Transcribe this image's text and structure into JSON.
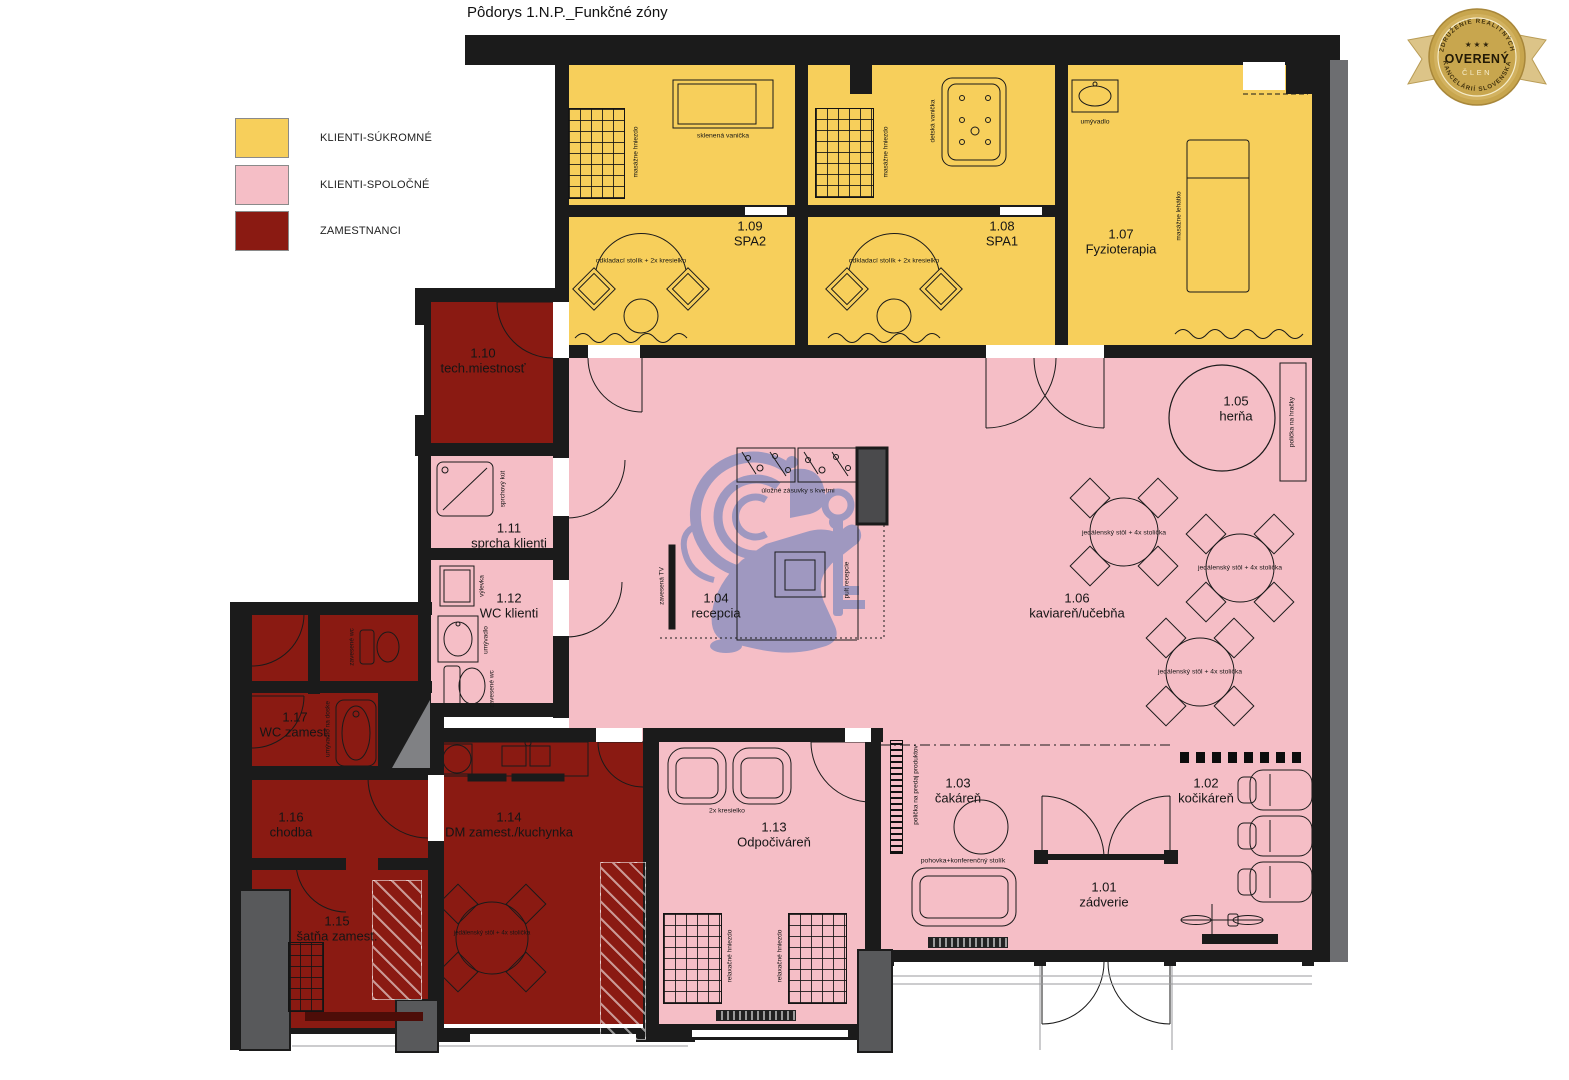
{
  "title": "Pôdorys 1.N.P._Funkčné zóny",
  "legend": {
    "private": {
      "label": "KLIENTI-SÚKROMNÉ",
      "color": "#f7cf5b"
    },
    "shared": {
      "label": "KLIENTI-SPOLOČNÉ",
      "color": "#f5bec6"
    },
    "staff": {
      "label": "ZAMESTNANCI",
      "color": "#8a1a12"
    }
  },
  "badge": {
    "arc_top": "ZDRUŽENIE REALITNÝCH",
    "arc_bottom": "KANCELÁRIÍ SLOVENSKA",
    "stars": "★ ★ ★",
    "title": "OVERENÝ",
    "subtitle": "ČLEN"
  },
  "colors": {
    "wall": "#1b1b1b",
    "pillar_gray": "#58595b",
    "watermark": "#8a8fbf"
  },
  "rooms": {
    "r101": {
      "num": "1.01",
      "name": "zádverie"
    },
    "r102": {
      "num": "1.02",
      "name": "kočikáreň"
    },
    "r103": {
      "num": "1.03",
      "name": "čakáreň"
    },
    "r104": {
      "num": "1.04",
      "name": "recepcia"
    },
    "r105": {
      "num": "1.05",
      "name": "herňa"
    },
    "r106": {
      "num": "1.06",
      "name": "kaviareň/učebňa"
    },
    "r107": {
      "num": "1.07",
      "name": "Fyzioterapia"
    },
    "r108": {
      "num": "1.08",
      "name": "SPA1"
    },
    "r109": {
      "num": "1.09",
      "name": "SPA2"
    },
    "r110": {
      "num": "1.10",
      "name": "tech.miestnosť"
    },
    "r111": {
      "num": "1.11",
      "name": "sprcha klienti"
    },
    "r112": {
      "num": "1.12",
      "name": "WC klienti"
    },
    "r113": {
      "num": "1.13",
      "name": "Odpočiváreň"
    },
    "r114": {
      "num": "1.14",
      "name": "DM zamest./kuchynka"
    },
    "r115": {
      "num": "1.15",
      "name": "šatňa zamest."
    },
    "r116": {
      "num": "1.16",
      "name": "chodba"
    },
    "r117": {
      "num": "1.17",
      "name": "WC zamest."
    }
  },
  "annotations": {
    "masazne_hniezdo": "masážne hniezdo",
    "sklenena_vanicka": "sklenená vanička",
    "detska_vanicka": "detská vanička",
    "odkladaci_stolik": "odkladací stolík + 2x kresielko",
    "umyvadlo": "umývadlo",
    "masazne_lehatko": "masážne lehátko",
    "policka_na_hracky": "polička na hračky",
    "zavesena_tv": "zavesená TV",
    "ulozne_zasuvky": "úložné zásuvky s kvetmi",
    "pult_recepcie": "pult recepcie",
    "jedalensky_stol": "jedálenský stôl + 4x stolička",
    "sprchovy_kut": "sprchový kút",
    "vylevka": "výlevka",
    "zavesene_wc": "zavesené wc",
    "umyvadlo_na_doske": "umývadlo na doske",
    "dve_kresielka": "2x kresielko",
    "relaxacne_hniezdo": "relaxačné hniezdo",
    "pohovka": "pohovka+konferenčný stolík",
    "policka_predaj": "polička na predaj produktov"
  }
}
